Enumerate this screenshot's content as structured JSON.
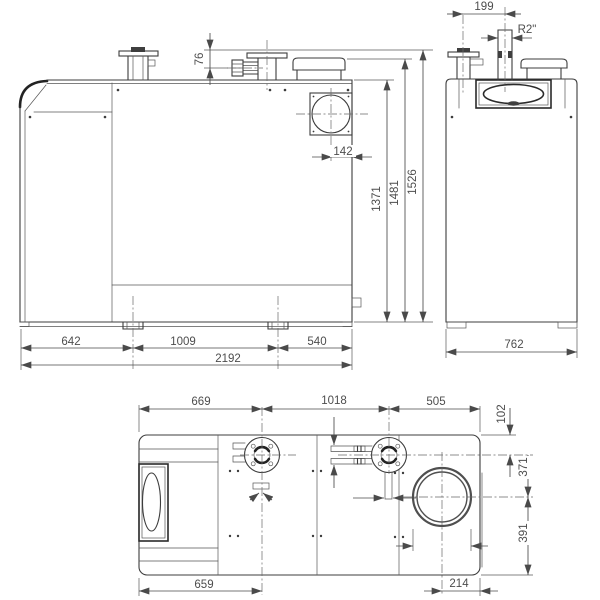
{
  "drawing": {
    "type": "technical-dimensional-drawing",
    "front_view": {
      "dims": {
        "pipe_height": "76",
        "flue_to_edge": "142",
        "height_body": "1371",
        "height_collar": "1481",
        "height_total": "1526",
        "foot_left": "642",
        "foot_spacing": "1009",
        "foot_right": "540",
        "total_length": "2192"
      }
    },
    "side_view": {
      "dims": {
        "pipe_offset": "199",
        "pipe_thread": "R2\"",
        "total_width": "762"
      }
    },
    "top_view": {
      "dims": {
        "front_to_flange1": "669",
        "flange_spacing": "1018",
        "flange2_to_rear": "505",
        "edge_to_pipes": "102",
        "pipes_to_flue": "371",
        "flue_to_front": "391",
        "front_to_drain": "659",
        "flue_to_rear": "214"
      }
    }
  }
}
